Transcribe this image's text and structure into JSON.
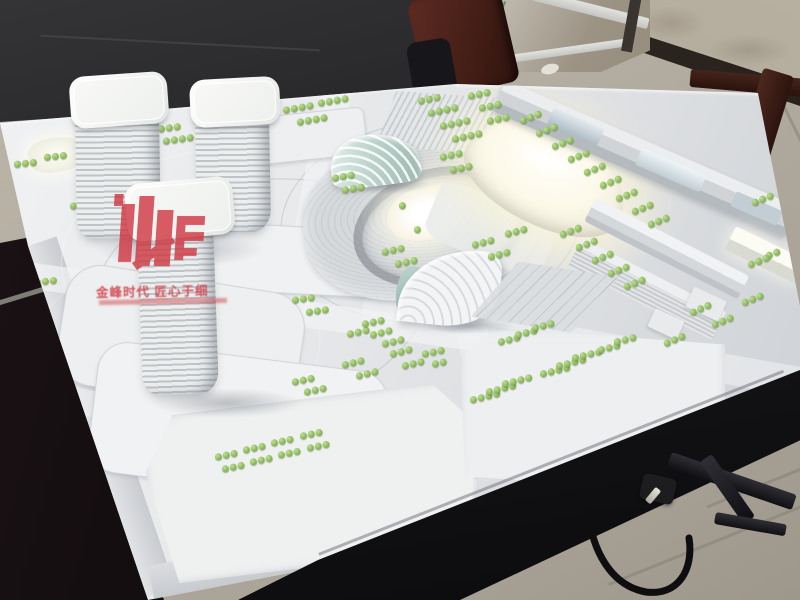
{
  "scene": {
    "subject": "Architectural scale model of a mixed-use district on a black display table",
    "setting": "Showroom with black leather sofa, glass door, tiled floor"
  },
  "watermark": {
    "slogan": "金峰时代 匠心于细"
  },
  "colors": {
    "accent_red": "#cf3540",
    "tree_green": "#8fbc5e",
    "glow_warm": "#fdf9e3",
    "model_white": "#e8eaec",
    "table_black": "#131316",
    "floor_beige": "#b3aca0",
    "sofa_black": "#1c1a1b",
    "wood_maroon": "#4a2119"
  },
  "model": {
    "tower_count": 3,
    "lit_structures": [
      "main-exhibition-hall",
      "sunken-oval-plaza",
      "far-right-slab"
    ],
    "tree_rows": [
      [
        283,
        107,
        -10,
        4
      ],
      [
        297,
        119,
        -10,
        4
      ],
      [
        318,
        100,
        -10,
        4
      ],
      [
        150,
        127,
        -8,
        4
      ],
      [
        163,
        138,
        -8,
        4
      ],
      [
        86,
        133,
        -8,
        3
      ],
      [
        14,
        161,
        -6,
        3
      ],
      [
        44,
        154,
        -6,
        3
      ],
      [
        418,
        98,
        -12,
        3
      ],
      [
        428,
        110,
        -12,
        4
      ],
      [
        440,
        123,
        -12,
        4
      ],
      [
        452,
        136,
        -12,
        4
      ],
      [
        468,
        93,
        -12,
        3
      ],
      [
        479,
        105,
        -12,
        3
      ],
      [
        487,
        118,
        -12,
        3
      ],
      [
        440,
        154,
        -12,
        3
      ],
      [
        450,
        167,
        -12,
        3
      ],
      [
        332,
        175,
        -10,
        3
      ],
      [
        342,
        187,
        -10,
        3
      ],
      [
        520,
        118,
        -22,
        3
      ],
      [
        536,
        131,
        -22,
        3
      ],
      [
        552,
        144,
        -22,
        3
      ],
      [
        568,
        157,
        -22,
        3
      ],
      [
        584,
        170,
        -22,
        3
      ],
      [
        600,
        183,
        -22,
        3
      ],
      [
        616,
        196,
        -22,
        3
      ],
      [
        632,
        209,
        -22,
        3
      ],
      [
        648,
        222,
        -22,
        3
      ],
      [
        560,
        232,
        -22,
        3
      ],
      [
        576,
        245,
        -22,
        3
      ],
      [
        592,
        258,
        -22,
        3
      ],
      [
        608,
        271,
        -22,
        3
      ],
      [
        624,
        284,
        -22,
        3
      ],
      [
        752,
        200,
        -22,
        3
      ],
      [
        766,
        253,
        -22,
        2
      ],
      [
        748,
        262,
        -22,
        3
      ],
      [
        742,
        300,
        -22,
        3
      ],
      [
        712,
        322,
        -22,
        3
      ],
      [
        690,
        310,
        -24,
        3
      ],
      [
        664,
        341,
        -24,
        3
      ],
      [
        70,
        203,
        -8,
        3
      ],
      [
        82,
        216,
        -8,
        3
      ],
      [
        12,
        267,
        -6,
        3
      ],
      [
        34,
        279,
        -6,
        3
      ],
      [
        382,
        249,
        -12,
        3
      ],
      [
        395,
        261,
        -12,
        3
      ],
      [
        472,
        242,
        -15,
        3
      ],
      [
        488,
        254,
        -15,
        3
      ],
      [
        505,
        231,
        -15,
        3
      ],
      [
        292,
        297,
        -8,
        3
      ],
      [
        306,
        309,
        -8,
        3
      ],
      [
        422,
        351,
        -12,
        3
      ],
      [
        432,
        361,
        -12,
        2
      ],
      [
        347,
        331,
        -12,
        3
      ],
      [
        362,
        321,
        -12,
        3
      ],
      [
        498,
        339,
        -14,
        3
      ],
      [
        515,
        332,
        -14,
        3
      ],
      [
        532,
        325,
        -14,
        3
      ],
      [
        215,
        454,
        -12,
        3
      ],
      [
        222,
        466,
        -12,
        3
      ],
      [
        243,
        447,
        -12,
        3
      ],
      [
        250,
        459,
        -12,
        3
      ],
      [
        271,
        440,
        -12,
        3
      ],
      [
        278,
        452,
        -12,
        3
      ],
      [
        300,
        433,
        -12,
        3
      ],
      [
        307,
        445,
        -12,
        3
      ],
      [
        342,
        362,
        -14,
        3
      ],
      [
        356,
        373,
        -14,
        3
      ],
      [
        292,
        379,
        -12,
        3
      ],
      [
        304,
        389,
        -12,
        3
      ],
      [
        390,
        351,
        -14,
        3
      ],
      [
        402,
        363,
        -14,
        3
      ],
      [
        370,
        332,
        -14,
        3
      ],
      [
        382,
        341,
        -14,
        3
      ],
      [
        470,
        397,
        -14,
        4
      ],
      [
        486,
        389,
        -14,
        4
      ],
      [
        502,
        381,
        -14,
        4
      ],
      [
        540,
        371,
        -14,
        4
      ],
      [
        556,
        363,
        -14,
        4
      ],
      [
        572,
        355,
        -14,
        4
      ],
      [
        598,
        347,
        -14,
        3
      ],
      [
        614,
        339,
        -14,
        3
      ],
      [
        399,
        203,
        -15,
        1
      ],
      [
        414,
        227,
        -15,
        1
      ]
    ]
  }
}
